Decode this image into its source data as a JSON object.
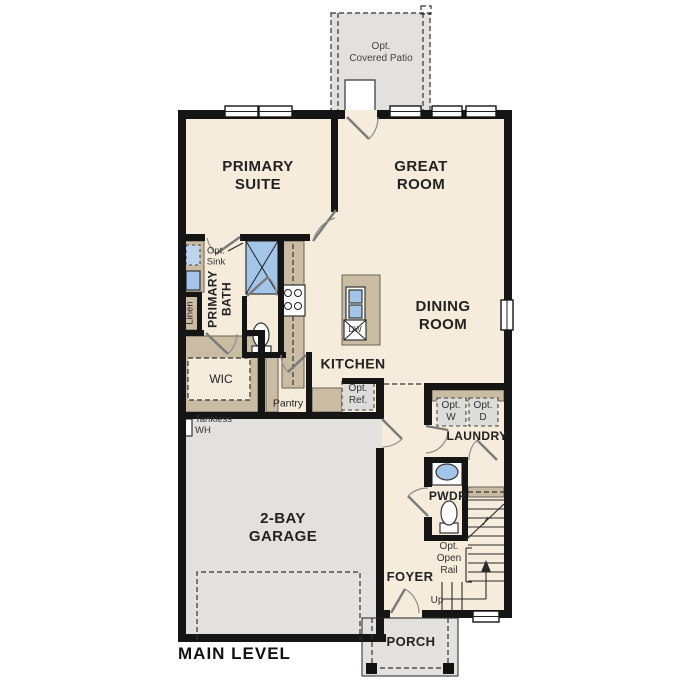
{
  "plan": {
    "title": "MAIN LEVEL",
    "rooms": {
      "primary_suite": "PRIMARY\nSUITE",
      "great_room": "GREAT\nROOM",
      "dining_room": "DINING\nROOM",
      "kitchen": "KITCHEN",
      "primary_bath": "PRIMARY\nBATH",
      "wic": "WIC",
      "pantry": "Pantry",
      "linen": "Linen",
      "laundry": "LAUNDRY",
      "powder": "PWDR",
      "foyer": "FOYER",
      "garage": "2-BAY\nGARAGE",
      "porch": "PORCH",
      "patio": "Opt.\nCovered Patio"
    },
    "annotations": {
      "opt_sink": "Opt.\nSink",
      "opt_ref": "Opt.\nRef.",
      "opt_washer": "Opt.\nW",
      "opt_dryer": "Opt.\nD",
      "tankless_wh": "Tankless\nWH",
      "opt_open_rail": "Opt.\nOpen\nRail",
      "up": "Up",
      "dishwasher": "DW"
    },
    "colors": {
      "floor": "#f5ecdc",
      "outdoor": "#e2e1de",
      "cabinet": "#c9bca3",
      "fixture_blue": "#a3c6e8",
      "wall": "#151515"
    }
  }
}
